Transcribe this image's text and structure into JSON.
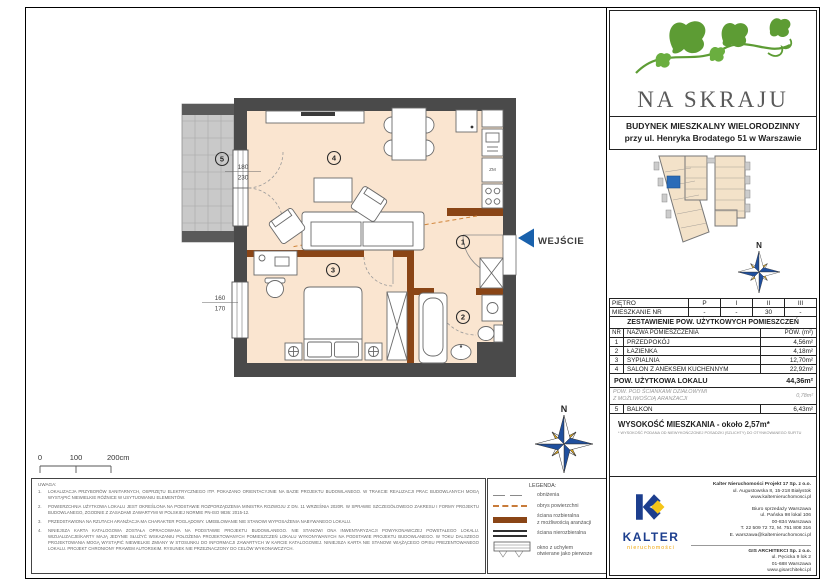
{
  "logo": {
    "name": "NA SKRAJU",
    "subtitle_line1": "BUDYNEK MIESZKALNY WIELORODZINNY",
    "subtitle_line2": "przy ul. Henryka Brodatego 51 w Warszawie"
  },
  "floor_table": {
    "row1_label": "PIĘTRO",
    "row2_label": "MIESZKANIE NR",
    "columns": [
      "P",
      "I",
      "II",
      "III"
    ],
    "values": [
      "-",
      "-",
      "30",
      "-"
    ]
  },
  "area_table": {
    "title": "ZESTAWIENIE POW. UŻYTKOWYCH POMIESZCZEŃ",
    "header_nr": "NR",
    "header_name": "NAZWA POMIESZCZENIA",
    "header_area": "POW. (m²)",
    "rows": [
      {
        "nr": "1",
        "name": "PRZEDPOKÓJ",
        "area": "4,56m²"
      },
      {
        "nr": "2",
        "name": "ŁAZIENKA",
        "area": "4,18m²"
      },
      {
        "nr": "3",
        "name": "SYPIALNIA",
        "area": "12,70m²"
      },
      {
        "nr": "4",
        "name": "SALON Z ANEKSEM KUCHENNYM",
        "area": "22,92m²"
      }
    ],
    "total_label": "POW. UŻYTKOWA LOKALU",
    "total_value": "44,36m²",
    "partition_label": "POW. POD ŚCIANKAMI DZIAŁOWYMI\nZ MOŻLIWOŚCIĄ ARANŻACJI",
    "partition_value": "0,78m²",
    "balcony_nr": "5",
    "balcony_name": "BALKON",
    "balcony_area": "6,43m²",
    "height_label": "WYSOKOŚĆ MIESZKANIA - około 2,57m*",
    "height_footnote": "* WYSOKOŚĆ PODANA OD NIEWYKOŃCZONEJ POSADZKI (SZLICHTY) DO OTYNKOWANEGO SUFITU"
  },
  "kalter": {
    "brand": "KALTER",
    "brand_sub": "nieruchomości",
    "company_lines": [
      "Kalter Nieruchomości Projekt 17 Sp. z o.o.",
      "ul. Augustowska 8, 15-218 Białystok",
      "www.kalternieruchomosci.pl"
    ],
    "office_lines": [
      "Biuro sprzedaży Warszawa",
      "ul. Pańska 98 lokal 106",
      "00-834 Warszawa",
      "T. 22 509 72 72, M. 751 808 316",
      "E. warszawa@kalternieruchomosci.pl"
    ],
    "architect_lines": [
      "GIS ARCHITEKCI Sp. z o.o.",
      "ul. Pęcicka 9 lok 2",
      "01-688 Warszawa",
      "www.gisarchitekci.pl"
    ]
  },
  "plan": {
    "rooms": {
      "r1": "1",
      "r2": "2",
      "r3": "3",
      "r4": "4",
      "r5": "5"
    },
    "entrance_label": "WEJŚCIE",
    "kitchen_label": "ZM",
    "dim_balcony_top": "180",
    "dim_balcony_bottom": "230",
    "dim_bedroom_top": "160",
    "dim_bedroom_bottom": "170",
    "compass_n": "N",
    "scale": {
      "t0": "0",
      "t100": "100",
      "t200": "200cm"
    }
  },
  "legend": {
    "title": "LEGENDA:",
    "items": [
      {
        "label": "obniżenia"
      },
      {
        "label": "obrys powierzchni"
      },
      {
        "label": "ściana rozbieralna\nz możliwością aranżacji"
      },
      {
        "label": "ściana nierozbieralna"
      },
      {
        "label": "okno z uchyłem\notwierane jako pierwsze"
      }
    ]
  },
  "notes": {
    "title": "UWAGA:",
    "items": [
      {
        "num": "1.",
        "text": "LOKALIZACJA PRZYBORÓW SANITARNYCH, OSPRZĘTU ELEKTRYCZNEGO ITP. POKAZANO ORIENTACYJNIE NA BAZIE PROJEKTU BUDOWLANEGO. W TRAKCIE REALIZACJI PRAC BUDOWLANYCH MOGĄ WYSTĄPIĆ NIEWIELKIE RÓŻNICE W USYTUOWANIU ELEMENTÓW."
      },
      {
        "num": "2.",
        "text": "POWIERZCHNIA UŻYTKOWA LOKALU JEST OKREŚLONA NA PODSTAWIE ROZPORZĄDZENIA MINISTRA ROZWOJU Z DN. 11 WRZEŚNIA 2020R. W SPRAWIE SZCZEGÓŁOWEGO ZAKRESU I FORMY PROJEKTU BUDOWLANEGO, ZGODNIE Z ZASADAMI ZAWARTYMI W POLSKIEJ NORMIE PN-ISO 9836: 2015-12."
      },
      {
        "num": "3.",
        "text": "PRZEDSTAWIONA NA RZUTACH ARANŻACJA MA CHARAKTER POGLĄDOWY. UMEBLOWANIE NIE STANOWI WYPOSAŻENIA NABYWANEGO LOKALU."
      },
      {
        "num": "4.",
        "text": "NINIEJSZA KARTA KATALOGOWA ZOSTAŁA OPRACOWANA NA PODSTAWIE PROJEKTU BUDOWLANEGO. NIE STANOWI ONA INWENTARYZACJI POWYKONAWCZEJ POWSTAŁEGO LOKALU. WIZUALIZACJE/KARTY MAJĄ JEDYNIE SŁUŻYĆ WSKAZANIU POŁOŻENIA PROJEKTOWANYCH POMIESZCZEŃ LOKALU WYKONYWANYCH NA PODSTAWIE PROJEKTU BUDOWLANEGO. W TOKU DALSZEGO PROJEKTOWANIA MOGĄ WYSTĄPIĆ NIEWIELKIE ZMIANY W STOSUNKU DO INFORMACJI ZAWARTYCH W KARCIE KATALOGOWEJ. NINIEJSZA KARTA NIE STANOWI WIĄŻĄCEGO OPISU PREZENTOWANEGO LOKALU. PROJEKT CHRONIONY PRAWEM AUTORSKIM. RYSUNEK NIE PRZEZNACZONY DO CELÓW WYKONAWCZYCH."
      }
    ]
  },
  "colors": {
    "wall_dark": "#4a4a4a",
    "wall_brown": "#8a4516",
    "room_fill": "#fae5d0",
    "entrance_blue": "#1961ac",
    "kalter_navy": "#1c3e8e",
    "kalter_yellow": "#f0a300",
    "ivy_green": "#5d9c34",
    "highlight_unit_blue": "#2b6cb8"
  }
}
